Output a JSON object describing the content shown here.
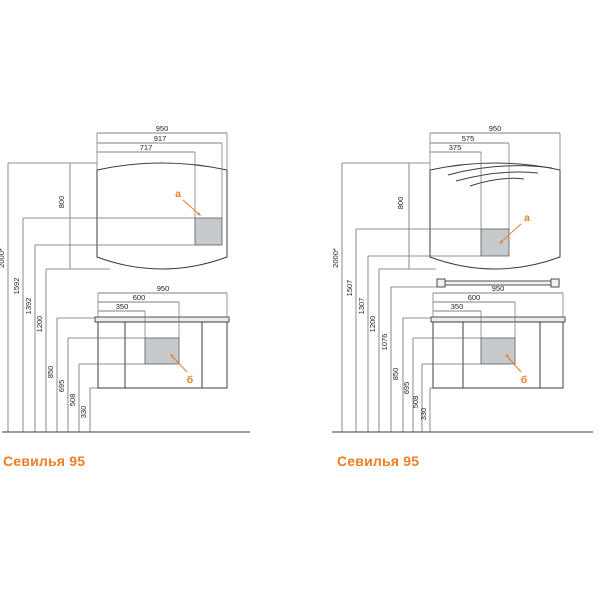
{
  "page": {
    "background": "#ffffff"
  },
  "colors": {
    "accent_orange": "#EE7D24",
    "outline": "#3c3c3c",
    "dimension_line": "#5a5a5a",
    "cutout_gray": "#c6cacc",
    "countertop_gray": "#ececec"
  },
  "diagrams": [
    {
      "title": "Севилья 95",
      "top_dims": {
        "full": "950",
        "mid": "917",
        "inner": "717"
      },
      "height_dims": {
        "total": "2000*",
        "h2": "1592",
        "h3": "1392",
        "h4": "1200"
      },
      "mirror_height": "800",
      "cabinet_dims": {
        "full": "950",
        "mid": "600",
        "inner": "350"
      },
      "bottom_dims": {
        "h1": "850",
        "h2": "695",
        "h3": "508",
        "h4": "330"
      },
      "labels": {
        "socket": "a",
        "cutout": "б"
      }
    },
    {
      "title": "Севилья 95",
      "top_dims": {
        "full": "950",
        "mid": "575",
        "inner": "375"
      },
      "height_dims": {
        "total": "2000*",
        "h2": "1507",
        "h3": "1307",
        "h4": "1200",
        "h5": "1076"
      },
      "mirror_height": "800",
      "cabinet_dims": {
        "full": "950",
        "mid": "600",
        "inner": "350"
      },
      "bottom_dims": {
        "h1": "850",
        "h2": "695",
        "h3": "508",
        "h4": "330"
      },
      "labels": {
        "socket": "a",
        "cutout": "б"
      }
    }
  ]
}
